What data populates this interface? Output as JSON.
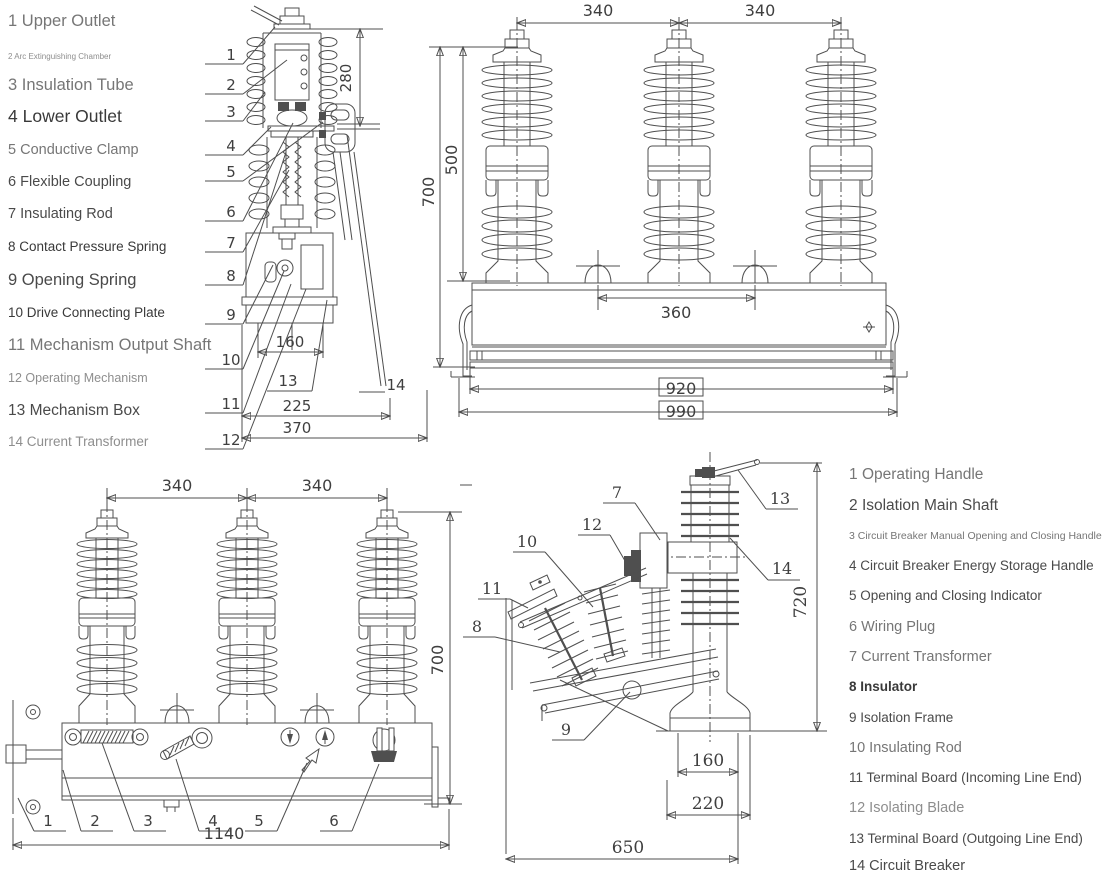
{
  "parts_list_left": {
    "items": [
      {
        "num": "1",
        "label": "Upper Outlet"
      },
      {
        "num": "2",
        "label": "Arc Extinguishing Chamber"
      },
      {
        "num": "3",
        "label": "Insulation Tube"
      },
      {
        "num": "4",
        "label": "Lower Outlet"
      },
      {
        "num": "5",
        "label": "Conductive Clamp"
      },
      {
        "num": "6",
        "label": "Flexible Coupling"
      },
      {
        "num": "7",
        "label": "Insulating Rod"
      },
      {
        "num": "8",
        "label": "Contact Pressure Spring"
      },
      {
        "num": "9",
        "label": "Opening Spring"
      },
      {
        "num": "10",
        "label": "Drive Connecting Plate"
      },
      {
        "num": "11",
        "label": "Mechanism Output Shaft"
      },
      {
        "num": "12",
        "label": "Operating Mechanism"
      },
      {
        "num": "13",
        "label": "Mechanism Box"
      },
      {
        "num": "14",
        "label": "Current Transformer"
      }
    ]
  },
  "parts_list_right": {
    "items": [
      {
        "num": "1",
        "label": "Operating Handle"
      },
      {
        "num": "2",
        "label": "Isolation Main Shaft"
      },
      {
        "num": "3",
        "label": "Circuit Breaker Manual Opening and Closing Handle"
      },
      {
        "num": "4",
        "label": "Circuit Breaker Energy Storage Handle"
      },
      {
        "num": "5",
        "label": "Opening and Closing Indicator"
      },
      {
        "num": "6",
        "label": "Wiring Plug"
      },
      {
        "num": "7",
        "label": "Current Transformer"
      },
      {
        "num": "8",
        "label": "Insulator"
      },
      {
        "num": "9",
        "label": "Isolation Frame"
      },
      {
        "num": "10",
        "label": "Insulating Rod"
      },
      {
        "num": "11",
        "label": "Terminal Board (Incoming Line End)"
      },
      {
        "num": "12",
        "label": "Isolating Blade"
      },
      {
        "num": "13",
        "label": "Terminal Board (Outgoing Line End)"
      },
      {
        "num": "14",
        "label": "Circuit Breaker"
      }
    ]
  },
  "section_view": {
    "leaders": [
      "1",
      "2",
      "3",
      "4",
      "5",
      "6",
      "7",
      "8",
      "9",
      "10",
      "11",
      "12"
    ],
    "box_leader": "13",
    "ct_leader": "14",
    "dim_height": "280",
    "dim_mech": "160",
    "dim_mid": "225",
    "dim_total": "370"
  },
  "front_view_top": {
    "dim_spacing_a": "340",
    "dim_spacing_b": "340",
    "dim_insulator": "500",
    "dim_height": "700",
    "dim_inner": "360",
    "dim_rail": "920",
    "dim_total": "990"
  },
  "front_view_bottom": {
    "dim_spacing_a": "340",
    "dim_spacing_b": "340",
    "dim_height": "700",
    "dim_total": "1140",
    "leaders": [
      "1",
      "2",
      "3",
      "4",
      "5",
      "6"
    ]
  },
  "side_view": {
    "leaders": {
      "n7": "7",
      "n8": "8",
      "n9": "9",
      "n10": "10",
      "n11": "11",
      "n12": "12",
      "n13": "13",
      "n14": "14"
    },
    "dim_height": "720",
    "dim_mount": "160",
    "dim_base": "220",
    "dim_total": "650"
  },
  "colors": {
    "line": "#4f4f4f",
    "text_dark": "#3f3f3f",
    "text_gray": "#767676",
    "background": "#ffffff"
  }
}
